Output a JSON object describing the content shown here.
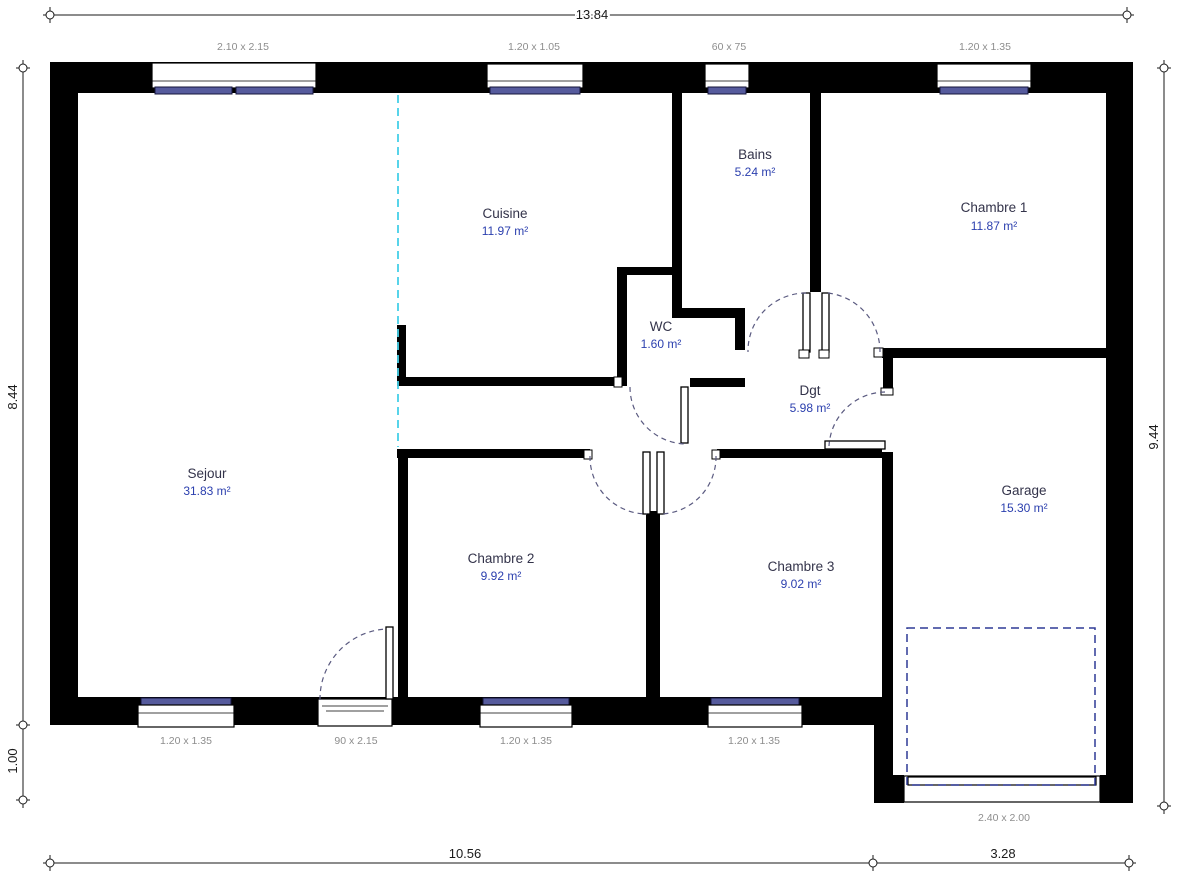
{
  "plan": {
    "rooms": [
      {
        "name": "Cuisine",
        "area": "11.97 m²"
      },
      {
        "name": "Bains",
        "area": "5.24 m²"
      },
      {
        "name": "Chambre 1",
        "area": "11.87 m²"
      },
      {
        "name": "WC",
        "area": "1.60 m²"
      },
      {
        "name": "Dgt",
        "area": "5.98 m²"
      },
      {
        "name": "Sejour",
        "area": "31.83 m²"
      },
      {
        "name": "Chambre 2",
        "area": "9.92 m²"
      },
      {
        "name": "Chambre 3",
        "area": "9.02 m²"
      },
      {
        "name": "Garage",
        "area": "15.30 m²"
      }
    ],
    "openings_top": [
      "2.10 x 2.15",
      "1.20 x 1.05",
      "60 x 75",
      "1.20 x 1.35"
    ],
    "openings_bottom": [
      "1.20 x 1.35",
      "90 x 2.15",
      "1.20 x 1.35",
      "1.20 x 1.35"
    ],
    "garage_door_label": "2.40 x 2.00",
    "dims": {
      "top": "13.84",
      "left_upper": "8.44",
      "left_lower": "1.00",
      "right": "9.44",
      "bottom_left": "10.56",
      "bottom_right": "3.28"
    },
    "colors": {
      "wall": "#000000",
      "window_glass": "#565b9d",
      "axis_line": "#45d0e8",
      "garage_dash": "#2f3a96"
    }
  }
}
